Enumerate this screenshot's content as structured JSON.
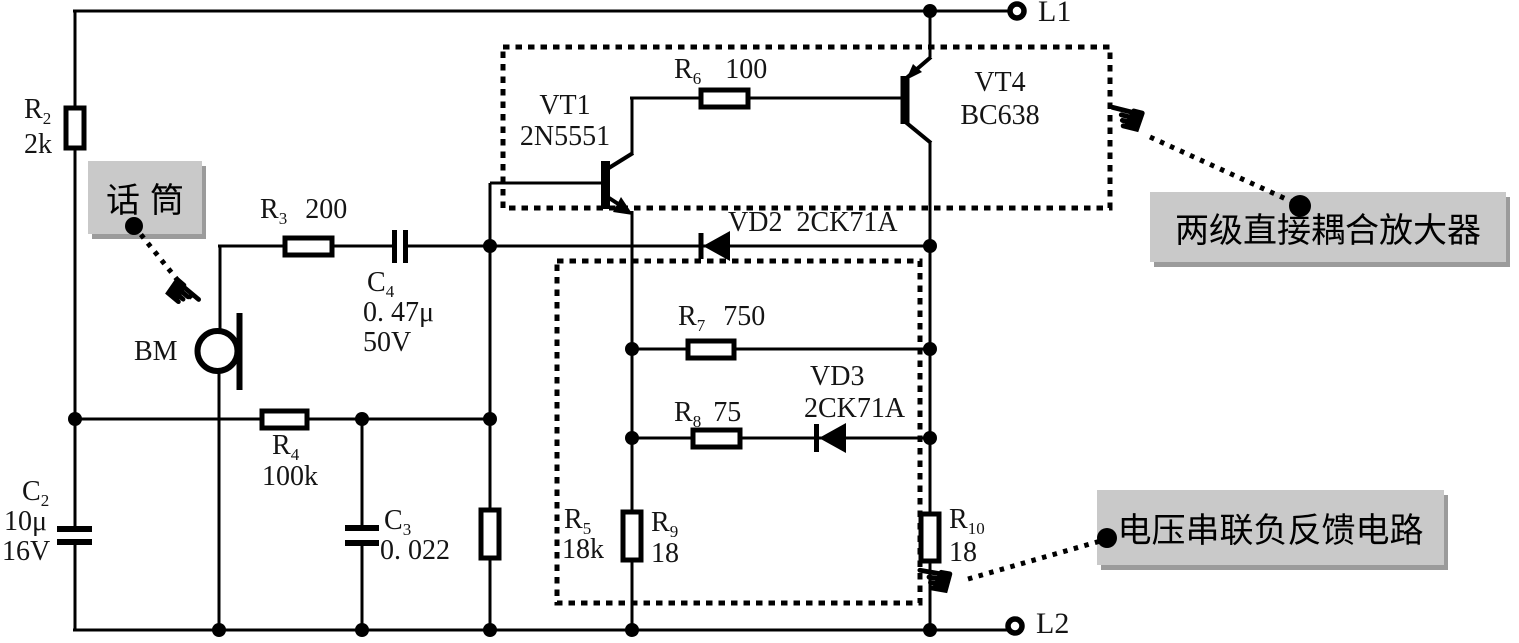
{
  "terminals": {
    "l1": "L1",
    "l2": "L2"
  },
  "callouts": {
    "mic": {
      "text": "话筒"
    },
    "amplifier": {
      "text": "两级直接耦合放大器"
    },
    "feedback": {
      "text": "电压串联负反馈电路"
    }
  },
  "icons": {
    "pointer_down_right": "☛",
    "pointer_left": "☚"
  },
  "colors": {
    "line": "#000000",
    "callout_bg": "#c9c9c9",
    "callout_shadow": "#9b9b9b"
  },
  "components": {
    "r2": {
      "ref": "R",
      "sub": "2",
      "value": "2k"
    },
    "r3": {
      "ref": "R",
      "sub": "3",
      "value": "200"
    },
    "r4": {
      "ref": "R",
      "sub": "4",
      "value": "100k"
    },
    "r5": {
      "ref": "R",
      "sub": "5",
      "value": "18k"
    },
    "r6": {
      "ref": "R",
      "sub": "6",
      "value": "100"
    },
    "r7": {
      "ref": "R",
      "sub": "7",
      "value": "750"
    },
    "r8": {
      "ref": "R",
      "sub": "8",
      "value": "75"
    },
    "r9": {
      "ref": "R",
      "sub": "9",
      "value": "18"
    },
    "r10": {
      "ref": "R",
      "sub": "10",
      "value": "18"
    },
    "c2": {
      "ref": "C",
      "sub": "2",
      "value": "10μ",
      "value2": "16V"
    },
    "c3": {
      "ref": "C",
      "sub": "3",
      "value": "0. 022"
    },
    "c4": {
      "ref": "C",
      "sub": "4",
      "value": "0. 47μ",
      "value2": "50V"
    },
    "vt1": {
      "name": "VT1",
      "model": "2N5551"
    },
    "vt4": {
      "name": "VT4",
      "model": "BC638"
    },
    "vd2": {
      "name": "VD2",
      "model": "2CK71A"
    },
    "vd3": {
      "name": "VD3",
      "model": "2CK71A"
    },
    "bm": {
      "name": "BM"
    }
  }
}
